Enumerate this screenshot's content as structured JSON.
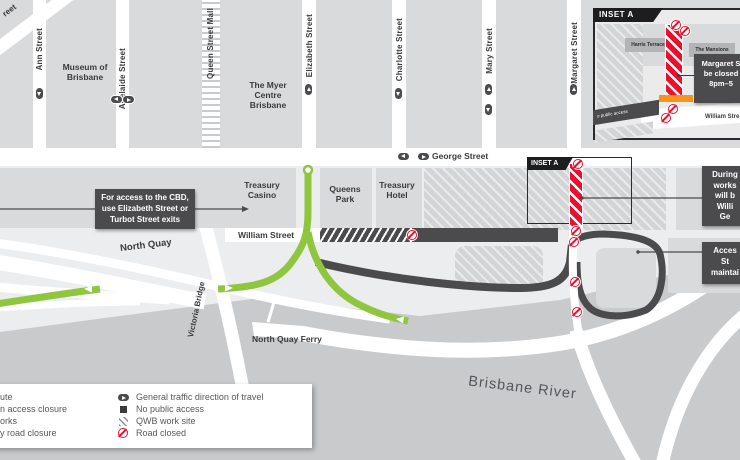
{
  "streets": {
    "ann": "Ann Street",
    "adelaide": "Adelaide Street",
    "queen_mall": "Queen Street Mall",
    "elizabeth": "Elizabeth Street",
    "charlotte": "Charlotte Street",
    "mary": "Mary Street",
    "margaret": "Margaret Street",
    "george": "George Street",
    "william": "William Street",
    "north_quay": "North Quay",
    "victoria_bridge": "Victoria Bridge",
    "corner_fragment": "reet"
  },
  "places": {
    "museum": "Museum of\nBrisbane",
    "myer": "The Myer\nCentre\nBrisbane",
    "treasury_casino": "Treasury\nCasino",
    "queens_park": "Queens\nPark",
    "treasury_hotel": "Treasury\nHotel",
    "ferry": "North Quay Ferry",
    "river": "Brisbane River"
  },
  "callouts": {
    "cbd": "For access to the CBD,\nuse Elizabeth Street or\nTurbot Street exits",
    "during_works": "During\nworks\nwill b\nWilli\nGe",
    "access_maintained": "Acces\nSt\nmaintai"
  },
  "inset": {
    "title": "INSET A",
    "map_tag": "INSET A",
    "harris": "Harris Terrace",
    "mansions": "The Mansions",
    "road_note": "o public access",
    "william": "William Stre",
    "callout": "Margaret S\nbe closed\n8pm–5"
  },
  "legend": {
    "left": [
      "ute",
      "n access closure",
      "orks",
      "y road closure"
    ],
    "right": [
      "General traffic direction of travel",
      "No public access",
      "QWB work site",
      "Road closed"
    ],
    "icons": [
      "traffic-direction-icon",
      "no-public-access-icon",
      "qwb-work-site-icon",
      "road-closed-icon"
    ]
  },
  "colors": {
    "route_green": "#8fc640",
    "closure_red": "#e8112d",
    "barrier_orange": "#f7941d",
    "dark_road": "#4b4b4d",
    "river": "#c9cacc",
    "block": "#d9dadb"
  }
}
